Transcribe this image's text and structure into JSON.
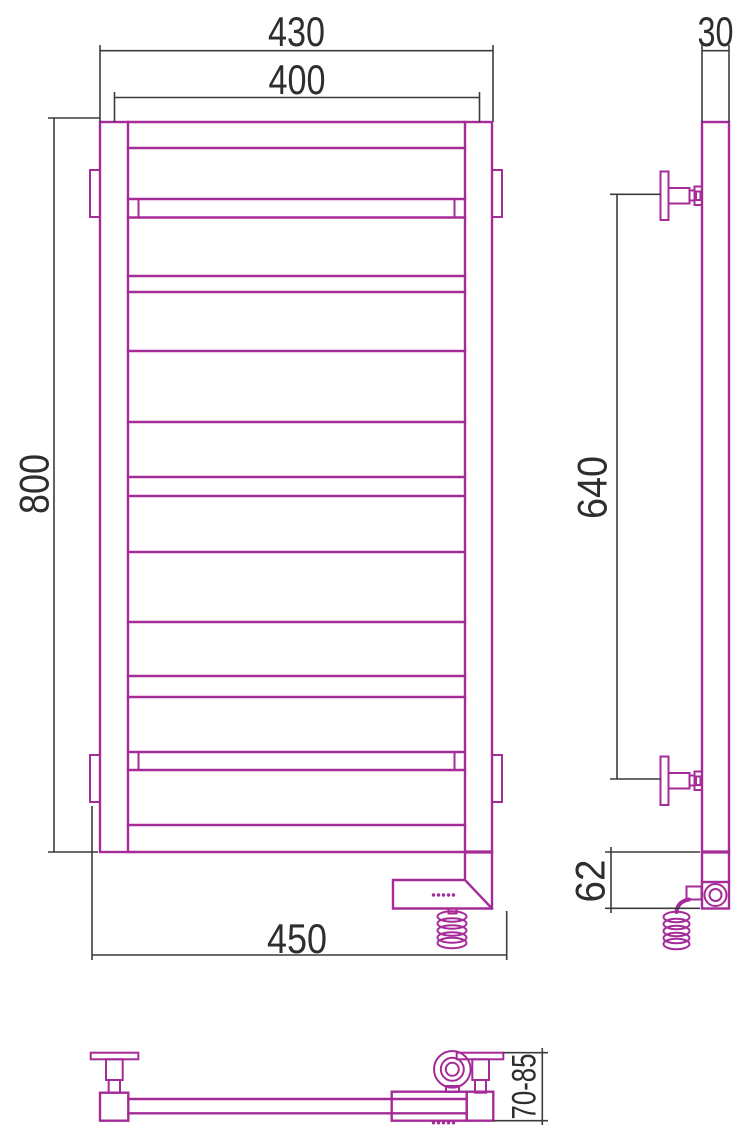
{
  "drawing": {
    "type": "technical-drawing",
    "subject": "electric-ladder-towel-rail-three-views",
    "colors": {
      "product": "#A52C98",
      "dimension": "#3C3C3C",
      "dimension_text": "#2E2E2E",
      "background": "#FFFFFF"
    },
    "dims": {
      "overall_width": "430",
      "axis_width": "400",
      "height": "800",
      "bracket_width": "450",
      "tube_depth": "30",
      "bracket_span": "640",
      "heater_unit_height": "62",
      "wall_clearance": "70-85"
    }
  }
}
